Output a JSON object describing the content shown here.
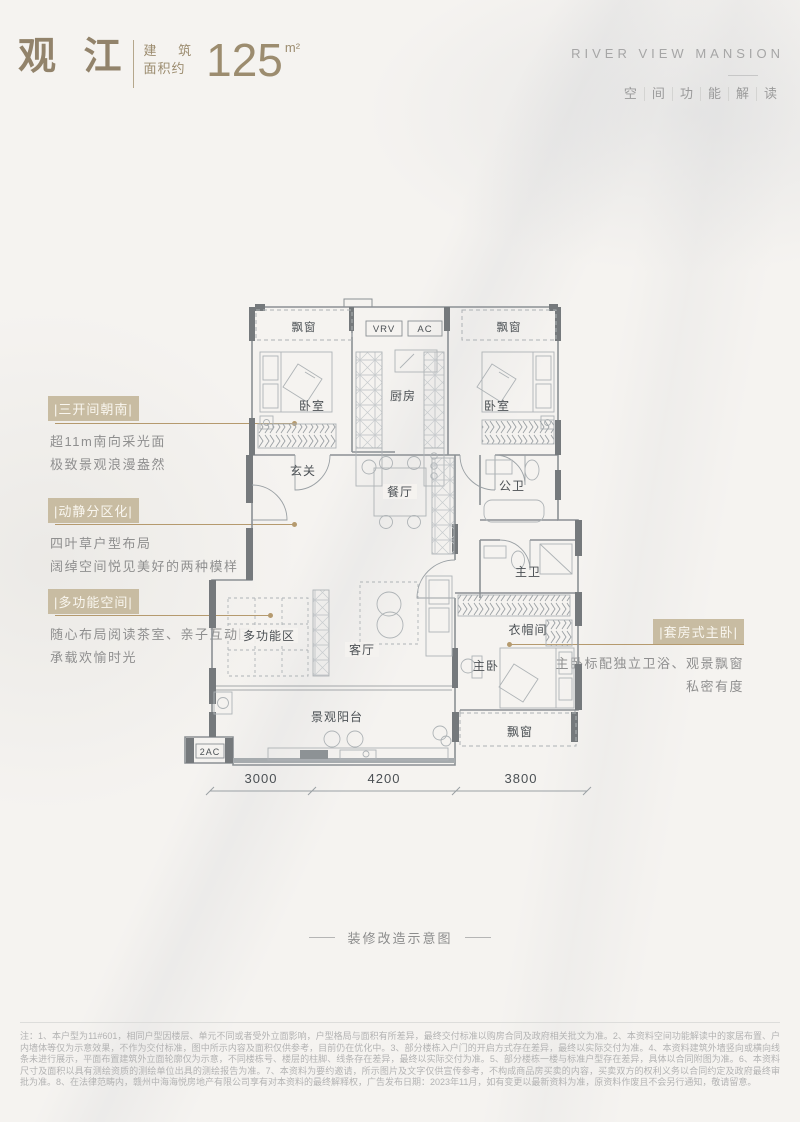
{
  "colors": {
    "accent_gold": "#b59a6e",
    "tag_bg": "#c8bca2",
    "title_tan": "#92836b",
    "gray_text": "#9a9a9a",
    "plan_line": "#8b9094",
    "wall_fill": "#75797c"
  },
  "header": {
    "title": "观 江",
    "area_label_top": "建 筑",
    "area_label_bottom": "面积约",
    "area_value": "125",
    "area_unit": "m²",
    "brand": "RIVER VIEW MANSION",
    "subtitle_chars": [
      "空",
      "间",
      "功",
      "能",
      "解",
      "读"
    ]
  },
  "annotations": {
    "a1": {
      "tag": "|三开间朝南|",
      "line1": "超11m南向采光面",
      "line2": "极致景观浪漫盎然"
    },
    "a2": {
      "tag": "|动静分区化|",
      "line1": "四叶草户型布局",
      "line2": "阔绰空间悦见美好的两种模样"
    },
    "a3": {
      "tag": "|多功能空间|",
      "line1": "随心布局阅读茶室、亲子互动区",
      "line2": "承载欢愉时光"
    },
    "a4": {
      "tag": "|套房式主卧|",
      "line1": "主卧标配独立卫浴、观景飘窗",
      "line2": "私密有度"
    }
  },
  "plan": {
    "labels": {
      "bay_tl": "飘窗",
      "vrv": "VRV",
      "ac": "AC",
      "bay_tr": "飘窗",
      "bedroom_l": "卧室",
      "kitchen": "厨房",
      "bedroom_r": "卧室",
      "foyer": "玄关",
      "dining": "餐厅",
      "bath_public": "公卫",
      "bath_master": "主卫",
      "multi": "多功能区",
      "living": "客厅",
      "cloak": "衣帽间",
      "master": "主卧",
      "balcony": "景观阳台",
      "bay_b": "飘窗",
      "ac2": "2AC"
    },
    "dimensions": [
      "3000",
      "4200",
      "3800"
    ]
  },
  "footer": {
    "caption": "装修改造示意图",
    "disclaimer": "注：1、本户型为11#601，相同户型因楼层、单元不同或者受外立面影响，户型格局与面积有所差异，最终交付标准以购房合同及政府相关批文为准。2、本资料空间功能解读中的家居布置、户内墙体等仅为示意效果，不作为交付标准，图中所示内容及面积仅供参考，目前仍在优化中。3、部分楼栋入户门的开启方式存在差异，最终以实际交付为准。4、本资料建筑外墙竖向或横向线条未进行展示，平面布置建筑外立面轮廓仅为示意，不同楼栋号、楼层的柱脚、线条存在差异，最终以实际交付为准。5、部分楼栋一楼与标准户型存在差异，具体以合同附图为准。6、本资料尺寸及面积以具有测绘资质的测绘单位出具的测绘报告为准。7、本资料为要约邀请，所示图片及文字仅供宣传参考，不构成商品房买卖的内容，买卖双方的权利义务以合同约定及政府最终审批为准。8、在法律范畴内，赣州中海海悦房地产有限公司享有对本资料的最终解释权，广告发布日期：2023年11月，如有变更以最新资料为准，原资料作废且不会另行通知，敬请留意。"
  }
}
